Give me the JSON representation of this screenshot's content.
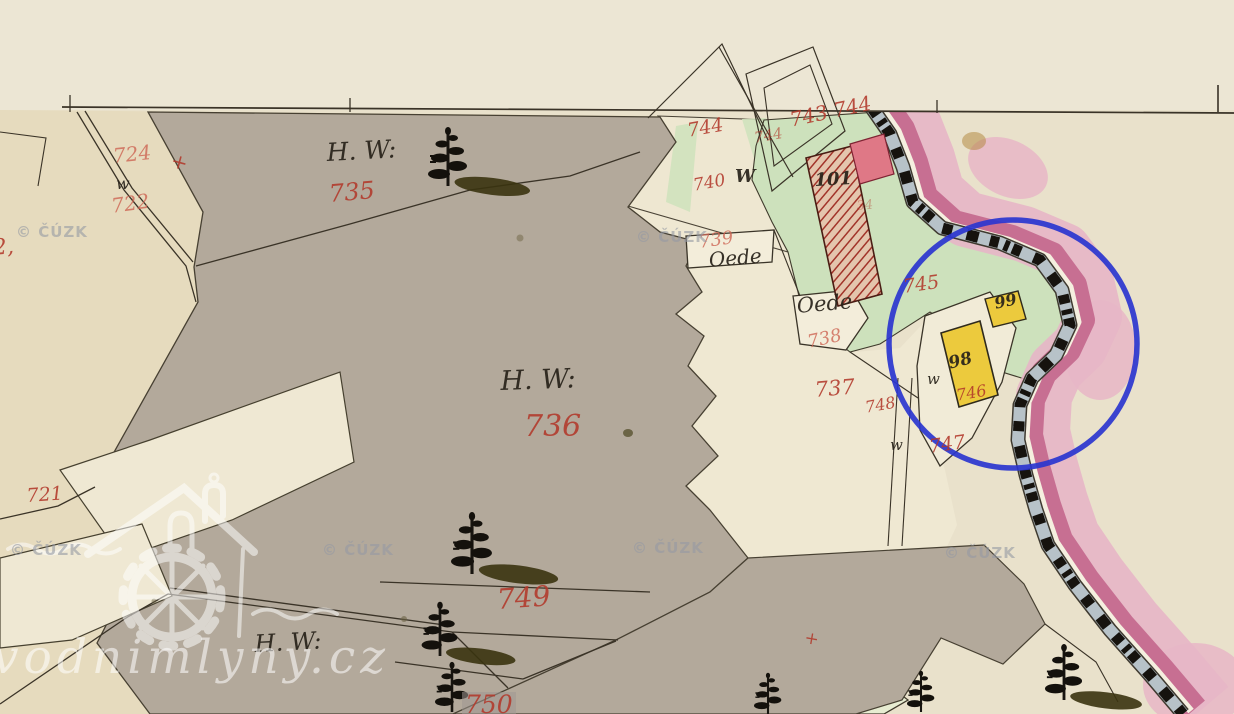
{
  "map": {
    "annotation_color": "#2a35cf",
    "paper_color": "#eae2cc",
    "forest_gray": "#b3a99b",
    "meadow_green": "#cde1bc",
    "building_yellow": "#ecca3d",
    "building_red": "#a23329",
    "river_pink_dark": "#c76f92",
    "river_pink_light": "#e7b6c7",
    "stream_blue_gray": "#b7c2c8",
    "labels": [
      {
        "name": "parcel-number-712-partial",
        "text": "2,",
        "x": -8,
        "y": 238,
        "size": 22,
        "color": "red",
        "rot": -5
      },
      {
        "name": "parcel-number-724",
        "text": "724",
        "x": 112,
        "y": 146,
        "size": 20,
        "color": "salmon",
        "rot": -6
      },
      {
        "name": "boundary-cross-724",
        "text": "+",
        "x": 174,
        "y": 150,
        "size": 20,
        "color": "red",
        "rot": 15
      },
      {
        "name": "parcel-number-722",
        "text": "722",
        "x": 110,
        "y": 196,
        "size": 20,
        "color": "salmon",
        "rot": -8
      },
      {
        "name": "landuse-hw-label-735",
        "text": "H. W:",
        "x": 326,
        "y": 140,
        "size": 25,
        "color": "black",
        "rot": -3
      },
      {
        "name": "parcel-number-735",
        "text": "735",
        "x": 328,
        "y": 182,
        "size": 24,
        "color": "red",
        "rot": -5
      },
      {
        "name": "landuse-hw-label-736",
        "text": "H. W:",
        "x": 500,
        "y": 368,
        "size": 27,
        "color": "black",
        "rot": -2
      },
      {
        "name": "parcel-number-736",
        "text": "736",
        "x": 524,
        "y": 412,
        "size": 30,
        "color": "red",
        "rot": 0
      },
      {
        "name": "parcel-number-721",
        "text": "721",
        "x": 26,
        "y": 487,
        "size": 19,
        "color": "red",
        "rot": -4
      },
      {
        "name": "parcel-number-749",
        "text": "749",
        "x": 496,
        "y": 586,
        "size": 28,
        "color": "red",
        "rot": -4
      },
      {
        "name": "landuse-hw-label-bottom",
        "text": "H. W:",
        "x": 254,
        "y": 632,
        "size": 24,
        "color": "black",
        "rot": -3
      },
      {
        "name": "parcel-number-750",
        "text": "750",
        "x": 462,
        "y": 692,
        "size": 25,
        "color": "red",
        "rot": 0,
        "chip": true
      },
      {
        "name": "parcel-number-744",
        "text": "744",
        "x": 686,
        "y": 122,
        "size": 19,
        "color": "red",
        "rot": -10
      },
      {
        "name": "parcel-number-744-faint",
        "text": "744",
        "x": 753,
        "y": 131,
        "size": 15,
        "color": "red",
        "rot": -10,
        "op": 0.7
      },
      {
        "name": "parcel-number-743-744",
        "text": "743 744",
        "x": 788,
        "y": 110,
        "size": 20,
        "color": "red",
        "rot": -12
      },
      {
        "name": "well-mark-w-740",
        "text": "W",
        "x": 735,
        "y": 168,
        "size": 18,
        "color": "black",
        "bold": true,
        "rot": 0
      },
      {
        "name": "parcel-number-740",
        "text": "740",
        "x": 692,
        "y": 178,
        "size": 17,
        "color": "red",
        "rot": -10
      },
      {
        "name": "well-mark-w-722",
        "text": "w",
        "x": 116,
        "y": 176,
        "size": 16,
        "color": "black",
        "rot": 0
      },
      {
        "name": "parcel-number-739",
        "text": "739",
        "x": 698,
        "y": 234,
        "size": 18,
        "color": "salmon",
        "rot": -8
      },
      {
        "name": "oede-label-739",
        "text": "Oede",
        "x": 708,
        "y": 250,
        "size": 20,
        "color": "black",
        "rot": -5
      },
      {
        "name": "oede-label-738",
        "text": "Oede",
        "x": 796,
        "y": 296,
        "size": 21,
        "color": "black",
        "rot": -5
      },
      {
        "name": "parcel-number-738",
        "text": "738",
        "x": 806,
        "y": 334,
        "size": 18,
        "color": "salmon",
        "rot": -12
      },
      {
        "name": "parcel-number-737",
        "text": "737",
        "x": 814,
        "y": 380,
        "size": 21,
        "color": "red",
        "rot": -5
      },
      {
        "name": "parcel-number-745",
        "text": "745",
        "x": 902,
        "y": 278,
        "size": 19,
        "color": "red",
        "rot": -8
      },
      {
        "name": "building-number-101",
        "text": "101",
        "x": 814,
        "y": 172,
        "size": 18,
        "color": "black",
        "bold": true,
        "rot": -3
      },
      {
        "name": "scribble-34",
        "text": "34",
        "x": 856,
        "y": 200,
        "size": 13,
        "color": "red",
        "rot": -5,
        "op": 0.45
      },
      {
        "name": "building-number-99",
        "text": "99",
        "x": 993,
        "y": 296,
        "size": 16,
        "color": "black",
        "bold": true,
        "rot": -12
      },
      {
        "name": "building-number-98",
        "text": "98",
        "x": 947,
        "y": 356,
        "size": 17,
        "color": "black",
        "bold": true,
        "rot": -14
      },
      {
        "name": "well-mark-w-98",
        "text": "w",
        "x": 927,
        "y": 372,
        "size": 15,
        "color": "black",
        "rot": 0
      },
      {
        "name": "parcel-number-746",
        "text": "746",
        "x": 955,
        "y": 388,
        "size": 16,
        "color": "red",
        "rot": -10
      },
      {
        "name": "parcel-number-748",
        "text": "748",
        "x": 864,
        "y": 400,
        "size": 16,
        "color": "red",
        "rot": -10
      },
      {
        "name": "well-mark-w-747",
        "text": "w",
        "x": 890,
        "y": 438,
        "size": 15,
        "color": "black",
        "rot": 0
      },
      {
        "name": "parcel-number-747",
        "text": "747",
        "x": 928,
        "y": 438,
        "size": 19,
        "color": "red",
        "rot": -8
      },
      {
        "name": "boundary-cross-bottom",
        "text": "+",
        "x": 806,
        "y": 630,
        "size": 17,
        "color": "red",
        "rot": 10
      }
    ],
    "watermarks": {
      "cuzk": {
        "text": "© ČÚZK",
        "positions": [
          [
            16,
            225
          ],
          [
            636,
            230
          ],
          [
            10,
            543
          ],
          [
            322,
            543
          ],
          [
            632,
            541
          ],
          [
            944,
            546
          ]
        ]
      },
      "logo": {
        "text": "vodnimlyny.cz"
      }
    },
    "trees": [
      {
        "x": 448,
        "y": 186,
        "s": 1.0,
        "shadow": true
      },
      {
        "x": 472,
        "y": 574,
        "s": 1.05,
        "shadow": true
      },
      {
        "x": 440,
        "y": 656,
        "s": 0.92,
        "shadow": true
      },
      {
        "x": 452,
        "y": 712,
        "s": 0.85,
        "shadow": false
      },
      {
        "x": 1064,
        "y": 700,
        "s": 0.95,
        "shadow": true
      },
      {
        "x": 768,
        "y": 714,
        "s": 0.7,
        "shadow": false
      },
      {
        "x": 921,
        "y": 712,
        "s": 0.7,
        "shadow": false
      }
    ],
    "buildings": [
      {
        "number": "101",
        "style": "red-hatched-masonry"
      },
      {
        "number": "98",
        "style": "yellow-wooden"
      },
      {
        "number": "99",
        "style": "yellow-wooden"
      }
    ]
  }
}
